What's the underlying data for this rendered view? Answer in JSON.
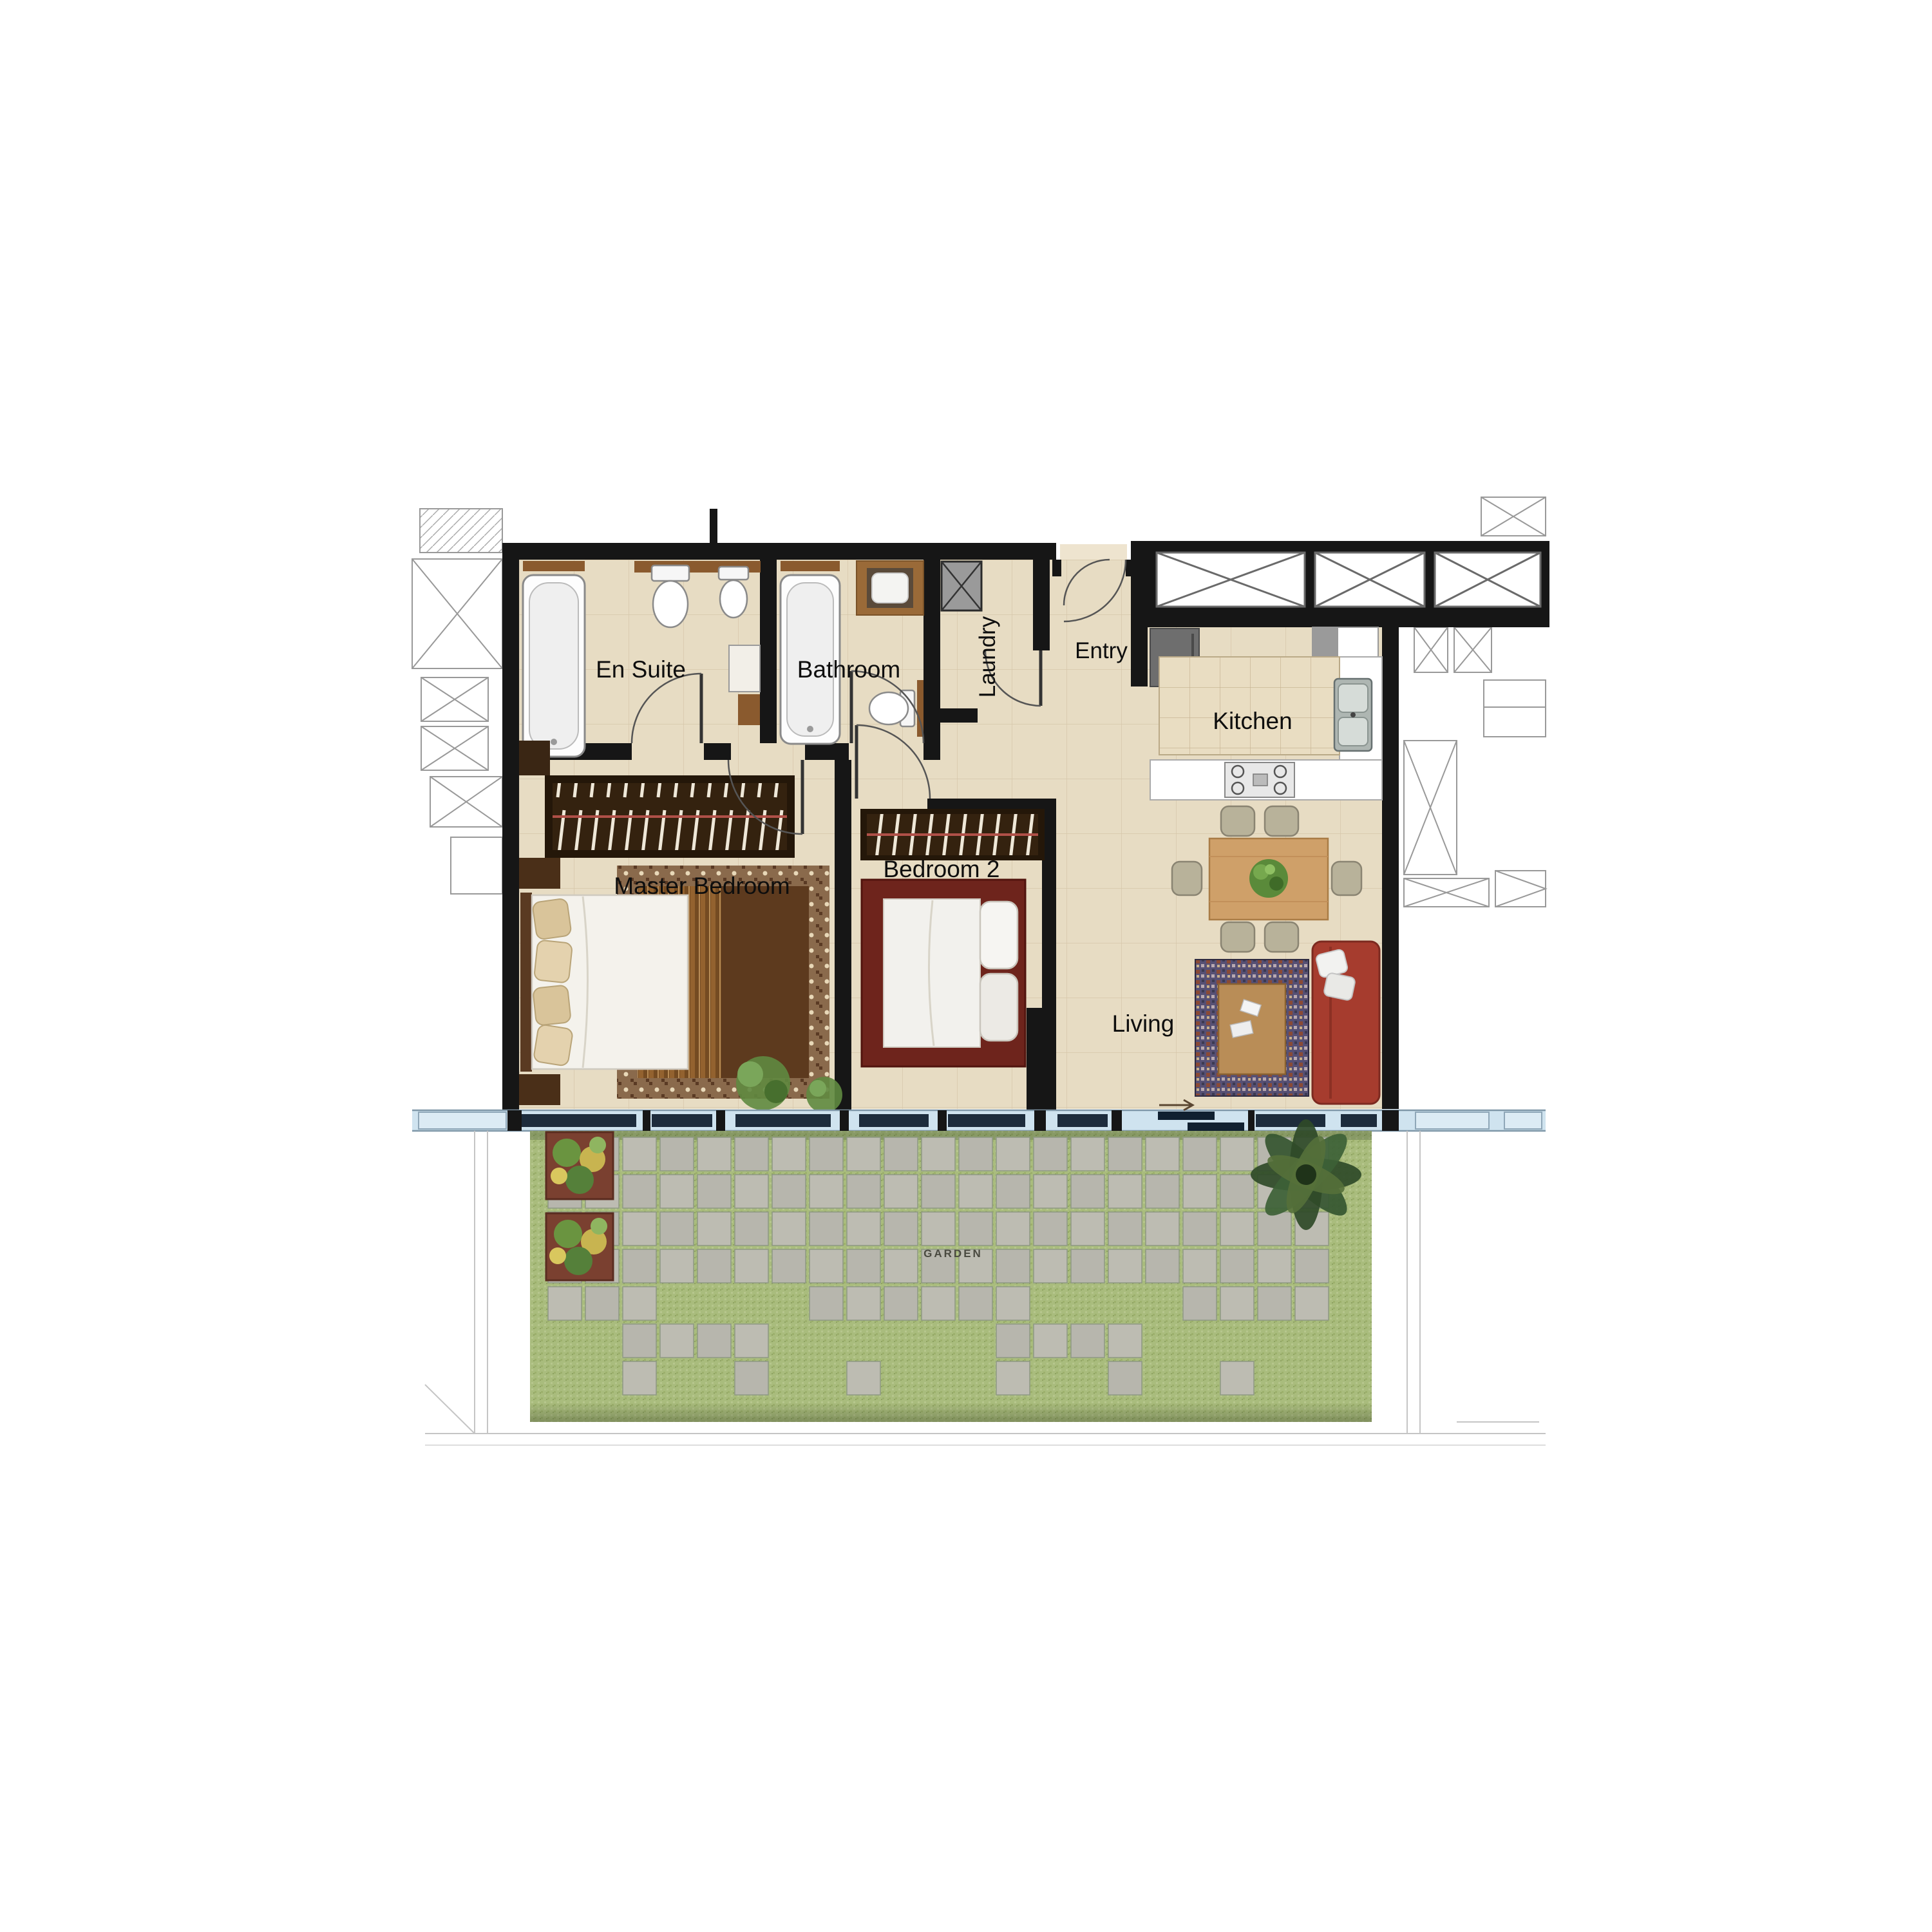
{
  "rooms": {
    "en_suite": "En Suite",
    "bathroom": "Bathroom",
    "laundry": "Laundry",
    "entry": "Entry",
    "kitchen": "Kitchen",
    "master_bedroom": "Master Bedroom",
    "bedroom_2": "Bedroom 2",
    "living": "Living",
    "garden": "GARDEN"
  },
  "colors": {
    "wall": "#161616",
    "floor": "#e7dcc3",
    "tile_line": "#c9b897",
    "garden_grass": "#a9bc7d",
    "paver": "#b7b6ad",
    "window_glass": "#cfe3ef",
    "sofa_red": "#a63c2e",
    "wood": "#9a6a38",
    "bed2_frame": "#6e241c"
  }
}
